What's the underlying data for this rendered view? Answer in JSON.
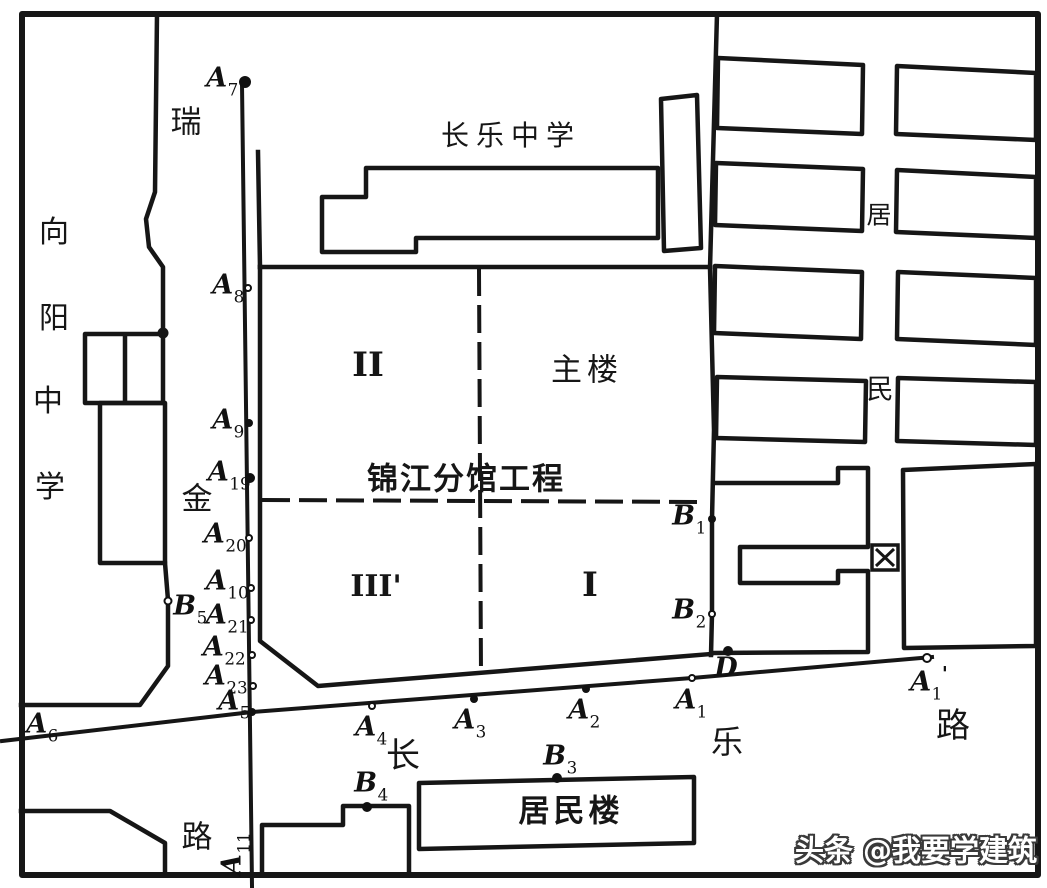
{
  "colors": {
    "ink": "#161616",
    "paper": "#ffffff"
  },
  "district_box": {
    "char": "区",
    "x": 872,
    "y": 545
  },
  "labels": [
    {
      "name": "xiangyang-school-char-xiang",
      "text": "向",
      "x": 54,
      "y": 233,
      "size": 30
    },
    {
      "name": "xiangyang-school-char-yang",
      "text": "阳",
      "x": 54,
      "y": 319,
      "size": 30
    },
    {
      "name": "xiangyang-school-char-zhong",
      "text": "中",
      "x": 48,
      "y": 402,
      "size": 30
    },
    {
      "name": "xiangyang-school-char-xue",
      "text": "学",
      "x": 50,
      "y": 488,
      "size": 30
    },
    {
      "name": "ruijin-road-char-rui",
      "text": "瑞",
      "x": 186,
      "y": 123,
      "size": 31
    },
    {
      "name": "ruijin-road-char-jin",
      "text": "金",
      "x": 197,
      "y": 500,
      "size": 31
    },
    {
      "name": "ruijin-road-char-lu",
      "text": "路",
      "x": 197,
      "y": 838,
      "size": 31
    },
    {
      "name": "changle-school-label",
      "text": "长乐中学",
      "x": 511,
      "y": 136,
      "size": 28,
      "spacing": 7
    },
    {
      "name": "main-building-label",
      "text": "主楼",
      "x": 587,
      "y": 371,
      "size": 31,
      "spacing": 5
    },
    {
      "name": "project-name-label",
      "text": "锦江分馆工程",
      "x": 466,
      "y": 480,
      "size": 31,
      "weight": 700,
      "spacing": 2
    },
    {
      "name": "zone-ii-label",
      "text": "II",
      "x": 368,
      "y": 365,
      "size": 34,
      "serif": true
    },
    {
      "name": "zone-iii-label",
      "text": "III'",
      "x": 376,
      "y": 587,
      "size": 30,
      "serif": true
    },
    {
      "name": "zone-i-label",
      "text": "I",
      "x": 590,
      "y": 585,
      "size": 34,
      "serif": true
    },
    {
      "name": "juminlou-building-label",
      "text": "居民楼",
      "x": 571,
      "y": 812,
      "size": 31,
      "weight": 700,
      "spacing": 4
    },
    {
      "name": "changle-road-char-chang",
      "text": "长",
      "x": 403,
      "y": 756,
      "size": 34
    },
    {
      "name": "changle-road-char-le",
      "text": "乐",
      "x": 727,
      "y": 742,
      "size": 32
    },
    {
      "name": "changle-road-char-lu",
      "text": "路",
      "x": 953,
      "y": 726,
      "size": 34
    },
    {
      "name": "jumin-area-char-ju",
      "text": "居",
      "x": 879,
      "y": 215,
      "size": 25
    },
    {
      "name": "jumin-area-char-min",
      "text": "民",
      "x": 880,
      "y": 390,
      "size": 27
    },
    {
      "name": "watermark",
      "text": "头条 @我要学建筑",
      "x": 916,
      "y": 851,
      "size": 29,
      "weight": 700,
      "outline": true
    }
  ],
  "points": [
    {
      "name": "A7",
      "base": "A",
      "sub": "7",
      "dot": "filled",
      "r": 6,
      "x": 245,
      "y": 82,
      "lx": 222,
      "ly": 80
    },
    {
      "name": "A8",
      "base": "A",
      "sub": "8",
      "dot": "open",
      "r": 4,
      "x": 248,
      "y": 288,
      "lx": 228,
      "ly": 287
    },
    {
      "name": "A9",
      "base": "A",
      "sub": "9",
      "dot": "filled",
      "r": 4,
      "x": 249,
      "y": 423,
      "lx": 228,
      "ly": 422
    },
    {
      "name": "A19",
      "base": "A",
      "sub": "19",
      "dot": "filled",
      "r": 5,
      "x": 250,
      "y": 478,
      "lx": 229,
      "ly": 474
    },
    {
      "name": "A20",
      "base": "A",
      "sub": "20",
      "dot": "open",
      "r": 4,
      "x": 249,
      "y": 538,
      "lx": 225,
      "ly": 536
    },
    {
      "name": "A10",
      "base": "A",
      "sub": "10",
      "dot": "open",
      "r": 4,
      "x": 251,
      "y": 588,
      "lx": 227,
      "ly": 583
    },
    {
      "name": "A21",
      "base": "A",
      "sub": "21",
      "dot": "open",
      "r": 4,
      "x": 251,
      "y": 620,
      "lx": 227,
      "ly": 617
    },
    {
      "name": "A22",
      "base": "A",
      "sub": "22",
      "dot": "open",
      "r": 4,
      "x": 252,
      "y": 655,
      "lx": 224,
      "ly": 649
    },
    {
      "name": "A23",
      "base": "A",
      "sub": "23",
      "dot": "open",
      "r": 4,
      "x": 253,
      "y": 686,
      "lx": 226,
      "ly": 678
    },
    {
      "name": "A5",
      "base": "A",
      "sub": "5",
      "dot": "filled",
      "r": 4,
      "x": 252,
      "y": 712,
      "lx": 234,
      "ly": 703
    },
    {
      "name": "A6",
      "base": "A",
      "sub": "6",
      "dot": "none",
      "r": 0,
      "x": 0,
      "y": 0,
      "lx": 42,
      "ly": 726
    },
    {
      "name": "A4",
      "base": "A",
      "sub": "4",
      "dot": "open",
      "r": 4,
      "x": 372,
      "y": 706,
      "lx": 371,
      "ly": 729
    },
    {
      "name": "A3",
      "base": "A",
      "sub": "3",
      "dot": "filled",
      "r": 4,
      "x": 474,
      "y": 699,
      "lx": 470,
      "ly": 722
    },
    {
      "name": "A2",
      "base": "A",
      "sub": "2",
      "dot": "filled",
      "r": 4,
      "x": 586,
      "y": 689,
      "lx": 584,
      "ly": 712
    },
    {
      "name": "A1",
      "base": "A",
      "sub": "1",
      "dot": "open",
      "r": 4,
      "x": 692,
      "y": 678,
      "lx": 691,
      "ly": 702
    },
    {
      "name": "A1-prime",
      "base": "A",
      "sub": "1",
      "prime": true,
      "dot": "open",
      "r": 5,
      "x": 927,
      "y": 658,
      "lx": 929,
      "ly": 682
    },
    {
      "name": "A11",
      "base": "A",
      "sub": "11",
      "dot": "none",
      "r": 0,
      "x": 0,
      "y": 0,
      "lx": 234,
      "ly": 854,
      "rotate": -90
    },
    {
      "name": "B1",
      "base": "B",
      "sub": "1",
      "dot": "filled",
      "r": 4,
      "x": 712,
      "y": 519,
      "lx": 689,
      "ly": 518
    },
    {
      "name": "B2",
      "base": "B",
      "sub": "2",
      "dot": "open",
      "r": 4,
      "x": 712,
      "y": 614,
      "lx": 689,
      "ly": 612
    },
    {
      "name": "B3",
      "base": "B",
      "sub": "3",
      "dot": "filled",
      "r": 5,
      "x": 557,
      "y": 778,
      "lx": 560,
      "ly": 758
    },
    {
      "name": "B4",
      "base": "B",
      "sub": "4",
      "dot": "filled",
      "r": 5,
      "x": 367,
      "y": 807,
      "lx": 371,
      "ly": 785
    },
    {
      "name": "B5",
      "base": "B",
      "sub": "5",
      "dot": "open",
      "r": 4.5,
      "x": 168,
      "y": 601,
      "lx": 190,
      "ly": 608
    },
    {
      "name": "D",
      "base": "D",
      "sub": "",
      "dot": "filled",
      "r": 5,
      "x": 728,
      "y": 651,
      "lx": 726,
      "ly": 668
    }
  ]
}
